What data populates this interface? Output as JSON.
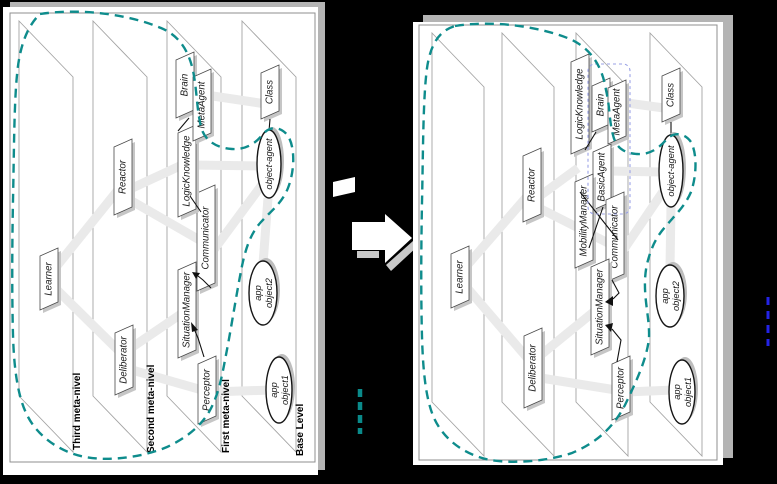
{
  "left_diagram": {
    "level_labels": {
      "third": "Third meta-nivel",
      "second": "Second meta-nivel",
      "first": "First meta-nivel",
      "base": "Base Level"
    },
    "nodes": {
      "learner": "Learner",
      "deliberator": "Deliberator",
      "reactor": "Reactor",
      "perceptor": "Perceptor",
      "situation_manager": "SituationManager",
      "communicator": "Communicator",
      "logic_knowledge": "LogicKnowledge",
      "brain": "Brain",
      "meta_agent": "MetaAgent",
      "class": "Class",
      "object_agent": "object-agent",
      "app_object2": {
        "line1": "app",
        "line2": "object2"
      },
      "app_object1": {
        "line1": "app",
        "line2": "object1"
      }
    }
  },
  "right_diagram": {
    "nodes": {
      "learner": "Learner",
      "deliberator": "Deliberator",
      "reactor": "Reactor",
      "perceptor": "Perceptor",
      "situation_manager": "SituationManager",
      "communicator": "Communicator",
      "mobility_manager": "MobilityManager",
      "basic_agent": "BasicAgent",
      "logic_knowledge": "LogicKnowledge",
      "brain": "Brain",
      "meta_agent": "MetaAgent",
      "class": "Class",
      "object_agent": "object-agent",
      "app_object2": {
        "line1": "app",
        "line2": "object2"
      },
      "app_object1": {
        "line1": "app",
        "line2": "object1"
      }
    }
  },
  "colors": {
    "selection_dash_teal": "#0e8c8c",
    "group_dash_violet": "#9aa2e6",
    "edge_dash_blue": "#2323e6",
    "beam_gray": "#eaeaea",
    "panel_shadow_gray": "#b4b4b4",
    "background": "#000000"
  }
}
